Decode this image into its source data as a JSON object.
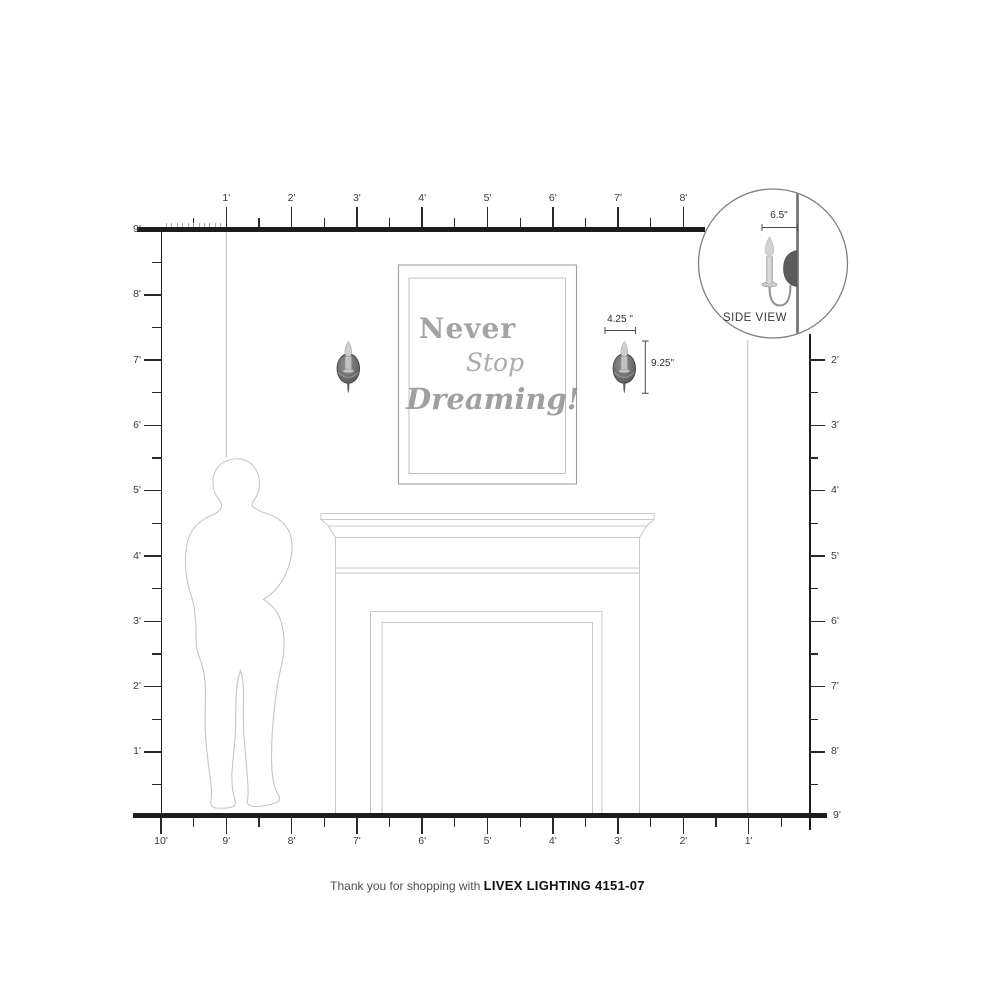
{
  "rulers": {
    "top": {
      "labels": [
        "1'",
        "2'",
        "3'",
        "4'",
        "5'",
        "6'",
        "7'",
        "8'"
      ]
    },
    "left": {
      "top_label": "9'",
      "labels": [
        "8'",
        "7'",
        "6'",
        "5'",
        "4'",
        "3'",
        "2'",
        "1'"
      ]
    },
    "right": {
      "labels": [
        "2'",
        "3'",
        "4'",
        "5'",
        "6'",
        "7'",
        "8'"
      ],
      "floor_label": "9'"
    },
    "bottom": {
      "labels": [
        "10'",
        "9'",
        "8'",
        "7'",
        "6'",
        "5'",
        "4'",
        "3'",
        "2'",
        "1'"
      ]
    }
  },
  "dimensions": {
    "sconce_width": "4.25 \"",
    "sconce_height": "9.25\"",
    "sconce_depth": "6.5\""
  },
  "side_view": {
    "label": "SIDE VIEW"
  },
  "artwork": {
    "line1": "Never",
    "line2": "Stop",
    "line3": "Dreaming!"
  },
  "footer": {
    "prefix": "Thank you for shopping with ",
    "product": "LIVEX LIGHTING 4151-07"
  },
  "colors": {
    "ruler_line": "#1d1d1d",
    "tick": "#2a2a2a",
    "grid_line": "#bdbdbd",
    "room_outline": "#c9c9c9",
    "frame_outline": "#9e9e9e",
    "artwork_text": "#a3a3a3",
    "sconce_body": "#555555",
    "label_text": "#3c3c3c"
  }
}
